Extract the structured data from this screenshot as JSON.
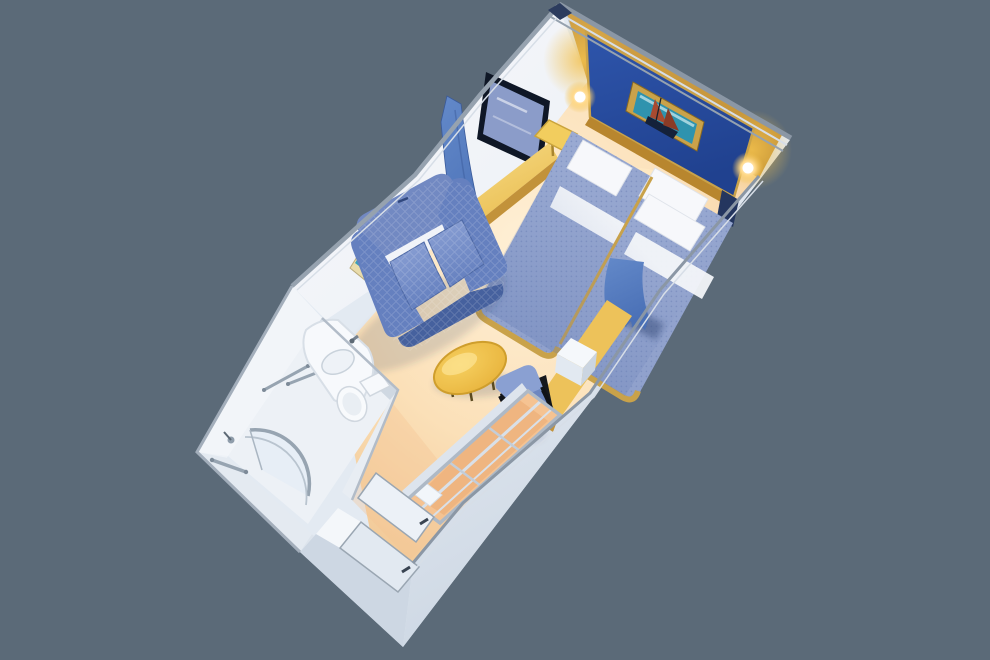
{
  "scene": {
    "description": "3D isometric cutaway rendering of a cruise ship interior stateroom floor plan",
    "room_type": "interior stateroom",
    "view": "aerial isometric cutaway, room rotated diagonally on plain background"
  },
  "colors": {
    "background": "#5b6a78",
    "shell": "#e3eaf2",
    "band_top": "#f0f4f9",
    "band_bottom": "#c9d4e1",
    "wall_shade_1": "#eef2f7",
    "wall_shade_2": "#dde4ec",
    "wall_shade_3": "#cdd7e3",
    "floor_center": "#fff0d6",
    "floor_mid": "#fbe0b8",
    "floor_edge": "#f1c794",
    "floor_warm": "#ffedc4",
    "corridor_warm": "#f3c392",
    "wall_face_light": "#f7f9fc",
    "wall_face": "#eceff5",
    "trim_gray": "#96a2af",
    "trim_light": "#d7dee7",
    "trim_dark": "#8b97a5",
    "mirror_frame": "#0f1726",
    "mirror_glass": "#8b9cc9",
    "counter_gold_light": "#f7dd8a",
    "counter_gold": "#e9bc4e",
    "counter_gold_dark": "#c2923a",
    "art_frame_cream": "#e9dcab",
    "art_teal": "#39a0ba",
    "art_red": "#a84a30",
    "art_dark": "#1c2a44",
    "gold_wall_dark": "#a9781f",
    "gold_wall": "#d9a94e",
    "gold_glow": "#f2c14e",
    "gold_strip": "#b8862e",
    "blue_wall": "#2e55ab",
    "blue_wall_dark": "#20418f",
    "gold_frame": "#c9a24a",
    "sconce_mid": "#ffd98a",
    "navy_post": "#24365f",
    "bed_base": "#8fa0cb",
    "bed_light": "#9dadd4",
    "bed_dark": "#5f78b2",
    "bed_dot": "#7084b8",
    "pillow": "#f7f8fb",
    "sheet": "#f3f5f9",
    "curtain": "#4a70b6",
    "curtain_light": "#6389c9",
    "curtain_dark": "#36549a",
    "sofa": "#6580bf",
    "sofa_light": "#8ea3d6",
    "sofa_back": "#7289c2",
    "sofa_dark": "#46619e",
    "table_top": "#f6d060",
    "table_edge": "#e8b33c",
    "table_rim": "#cf9e2c",
    "desk_top": "#edc25a",
    "cabinet_white": "#f5f8fb",
    "cabinet_front": "#e2e9f1",
    "cabinet_side": "#cbd5e1",
    "chair_back": "#8aa0d2",
    "chair_seat": "#6d87c0",
    "chair_frame": "#15181d",
    "closet_peach": "#f5c392",
    "closet_peach_dark": "#eeb27c",
    "closet_frame": "#aeb9c6",
    "bath_floor": "#edf1f6",
    "fixture_white": "#f7f9fc",
    "fixture_shade": "#d8dfe7",
    "chrome": "#97a4b1",
    "chrome_dark": "#5d6975",
    "door_light": "#ecf1f7",
    "door_mid": "#e2e9f1",
    "door_stroke": "#9aa6b2",
    "handle": "#394452",
    "shadow": "rgba(50,62,95,0.18)"
  },
  "objects": {
    "bedroom": {
      "bed_left": "twin bed with blue dotted spread",
      "bed_right": "twin bed with blue dotted spread",
      "pillows": "white pillows",
      "headboard_wall": "navy accent wall with gold trim",
      "painting": "framed sailboat artwork",
      "nightstand": "yellow side table",
      "sconce_left": "glowing wall lamp",
      "sconce_right": "glowing wall lamp",
      "mirror": "dark framed mirror",
      "vanity_counter": "gold vanity counter",
      "divider_curtain_left": "blue privacy curtain",
      "divider_curtain_right": "blue privacy curtain"
    },
    "living": {
      "sofa": "blue loveseat",
      "coffee_table": "yellow oval table",
      "wall_art": "nautical artwork",
      "desk": "yellow desk counter",
      "desk_cabinet": "white cabinet",
      "chair": "blue chair with black frame"
    },
    "bathroom": {
      "shower": "curved glass shower",
      "sink": "white washbasin vanity",
      "toilet": "toilet",
      "towel_bars": "chrome towel bars",
      "grab_bar": "chrome grab bar"
    },
    "entry": {
      "closet": "open wardrobe with shelves",
      "door_main": "cabin entry door",
      "door_bathroom": "bathroom door"
    }
  }
}
